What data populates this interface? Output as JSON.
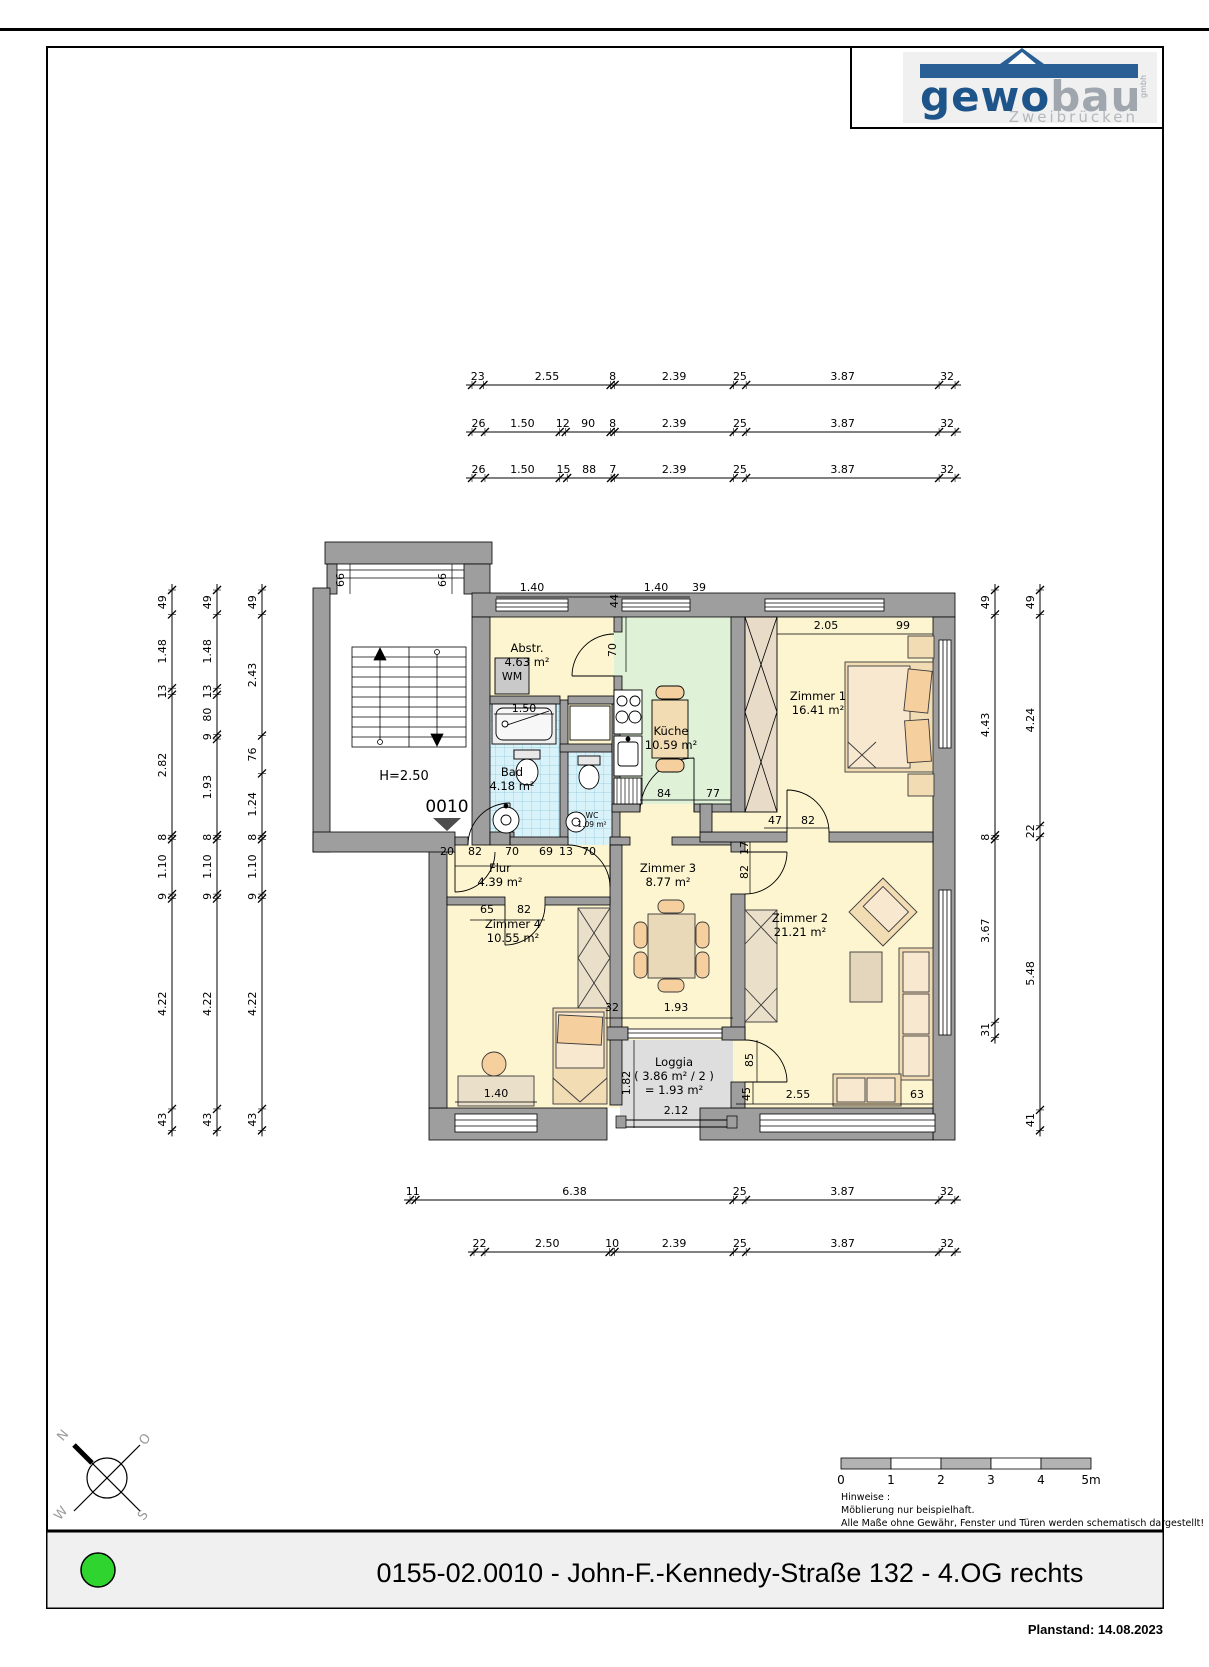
{
  "page": {
    "title_footer": "0155-02.0010 - John-F.-Kennedy-Straße 132 - 4.OG rechts",
    "planstand": "Planstand: 14.08.2023"
  },
  "logo": {
    "brand_dark": "gewo",
    "brand_light": "bau",
    "brand_small": "gmbh",
    "city": "Zweibrücken"
  },
  "plan": {
    "unit_number": "0010",
    "ceiling_height": "H=2.50",
    "wm_label": "WM",
    "rooms": [
      {
        "name": "Abstr.",
        "area": "4.63 m²",
        "x": 527,
        "y": 652
      },
      {
        "name": "Küche",
        "area": "10.59 m²",
        "x": 671,
        "y": 735
      },
      {
        "name": "Zimmer 1",
        "area": "16.41 m²",
        "x": 818,
        "y": 700
      },
      {
        "name": "Bad",
        "area": "4.18 m²",
        "x": 512,
        "y": 776
      },
      {
        "name": "WC",
        "area": "1.09 m²",
        "x": 592,
        "y": 818,
        "small": true
      },
      {
        "name": "Flur",
        "area": "4.39 m²",
        "x": 500,
        "y": 872
      },
      {
        "name": "Zimmer 3",
        "area": "8.77 m²",
        "x": 668,
        "y": 872
      },
      {
        "name": "Zimmer 2",
        "area": "21.21 m²",
        "x": 800,
        "y": 922
      },
      {
        "name": "Zimmer 4",
        "area": "10.55 m²",
        "x": 513,
        "y": 928
      },
      {
        "name": "Loggia",
        "area": "( 3.86 m² / 2 )",
        "area2": "= 1.93 m²",
        "x": 674,
        "y": 1066
      }
    ],
    "annotations": [
      {
        "t": "1.40",
        "x": 532,
        "y": 591
      },
      {
        "t": "44",
        "x": 618,
        "y": 601,
        "r": -90
      },
      {
        "t": "1.40",
        "x": 656,
        "y": 591
      },
      {
        "t": "39",
        "x": 699,
        "y": 591
      },
      {
        "t": "70",
        "x": 616,
        "y": 650,
        "r": -90
      },
      {
        "t": "2.05",
        "x": 826,
        "y": 629
      },
      {
        "t": "99",
        "x": 903,
        "y": 629
      },
      {
        "t": "1.50",
        "x": 524,
        "y": 712
      },
      {
        "t": "20",
        "x": 447,
        "y": 855
      },
      {
        "t": "82",
        "x": 475,
        "y": 855
      },
      {
        "t": "70",
        "x": 512,
        "y": 855
      },
      {
        "t": "69",
        "x": 546,
        "y": 855
      },
      {
        "t": "13",
        "x": 566,
        "y": 855
      },
      {
        "t": "70",
        "x": 589,
        "y": 855
      },
      {
        "t": "65",
        "x": 487,
        "y": 913
      },
      {
        "t": "82",
        "x": 524,
        "y": 913
      },
      {
        "t": "84",
        "x": 664,
        "y": 797
      },
      {
        "t": "77",
        "x": 713,
        "y": 797
      },
      {
        "t": "47",
        "x": 775,
        "y": 824
      },
      {
        "t": "82",
        "x": 808,
        "y": 824
      },
      {
        "t": "17",
        "x": 748,
        "y": 848,
        "r": -90
      },
      {
        "t": "82",
        "x": 748,
        "y": 872,
        "r": -90
      },
      {
        "t": "32",
        "x": 612,
        "y": 1011
      },
      {
        "t": "1.93",
        "x": 676,
        "y": 1011
      },
      {
        "t": "1.40",
        "x": 496,
        "y": 1097
      },
      {
        "t": "1.82",
        "x": 630,
        "y": 1083,
        "r": -90
      },
      {
        "t": "2.12",
        "x": 676,
        "y": 1114
      },
      {
        "t": "85",
        "x": 753,
        "y": 1060,
        "r": -90
      },
      {
        "t": "45",
        "x": 750,
        "y": 1094,
        "r": -90
      },
      {
        "t": "2.55",
        "x": 798,
        "y": 1098
      },
      {
        "t": "63",
        "x": 917,
        "y": 1098
      },
      {
        "t": "66",
        "x": 344,
        "y": 580,
        "r": -90
      },
      {
        "t": "66",
        "x": 446,
        "y": 580,
        "r": -90
      }
    ],
    "chains": {
      "top": [
        [
          "23",
          "2.55",
          "8",
          "2.39",
          "25",
          "3.87",
          "32"
        ],
        [
          "26",
          "1.50",
          "12",
          "90",
          "8",
          "2.39",
          "25",
          "3.87",
          "32"
        ],
        [
          "26",
          "1.50",
          "15",
          "88",
          "7",
          "2.39",
          "25",
          "3.87",
          "32"
        ]
      ],
      "left": [
        [
          "49",
          "1.48",
          "13",
          "2.82",
          "8",
          "1.10",
          "9",
          "4.22",
          "43"
        ],
        [
          "49",
          "1.48",
          "13",
          "80",
          "9",
          "1.93",
          "8",
          "1.10",
          "9",
          "4.22",
          "43"
        ],
        [
          "49",
          "2.43",
          "76",
          "1.24",
          "8",
          "1.10",
          "9",
          "4.22",
          "43"
        ]
      ],
      "right": [
        [
          "49",
          "4.43",
          "8",
          "3.67",
          "31"
        ],
        [
          "49",
          "4.24",
          "22",
          "5.48",
          "41"
        ]
      ],
      "bottom": [
        [
          "11",
          "6.38",
          "25",
          "3.87",
          "32"
        ],
        [
          "22",
          "2.50",
          "10",
          "2.39",
          "25",
          "3.87",
          "32"
        ]
      ]
    }
  },
  "scale_bar": {
    "labels": [
      "0",
      "1",
      "2",
      "3",
      "4",
      "5m"
    ]
  },
  "notes": {
    "heading": "Hinweise :",
    "lines": [
      "Möblierung nur beispielhaft.",
      "Alle Maße ohne Gewähr, Fenster und Türen werden schematisch dargestellt!"
    ]
  },
  "compass": {
    "n": "N",
    "e": "O",
    "s": "S",
    "w": "W"
  }
}
